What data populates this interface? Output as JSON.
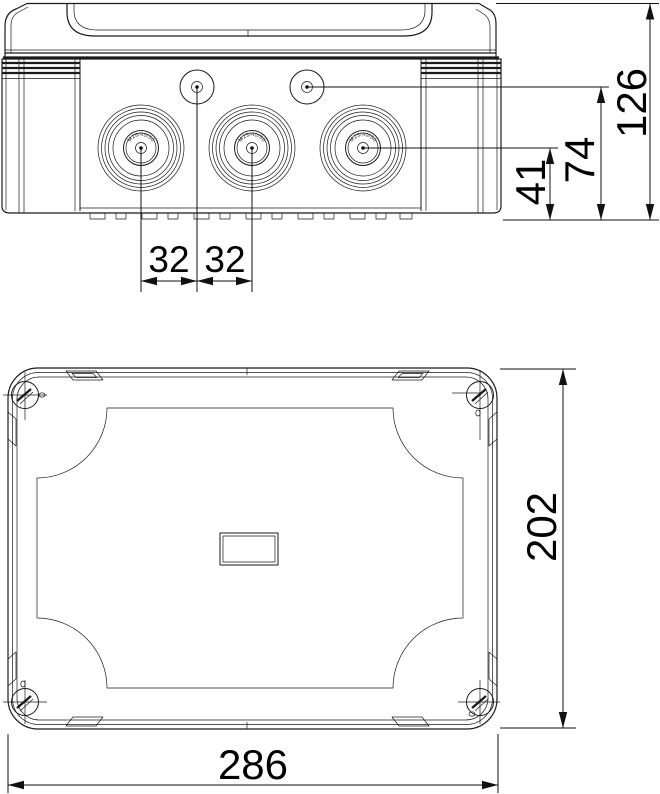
{
  "drawing": {
    "background_color": "#ffffff",
    "line_color": "#1b1b1b",
    "gland_marking": "M25/40/50",
    "dims": {
      "front": {
        "overall_height": "126",
        "knockout_axis_height": "74",
        "gland_axis_height": "41",
        "entry_pitch_left": "32",
        "entry_pitch_right": "32"
      },
      "top": {
        "box_width": "286",
        "box_depth": "202"
      }
    }
  }
}
